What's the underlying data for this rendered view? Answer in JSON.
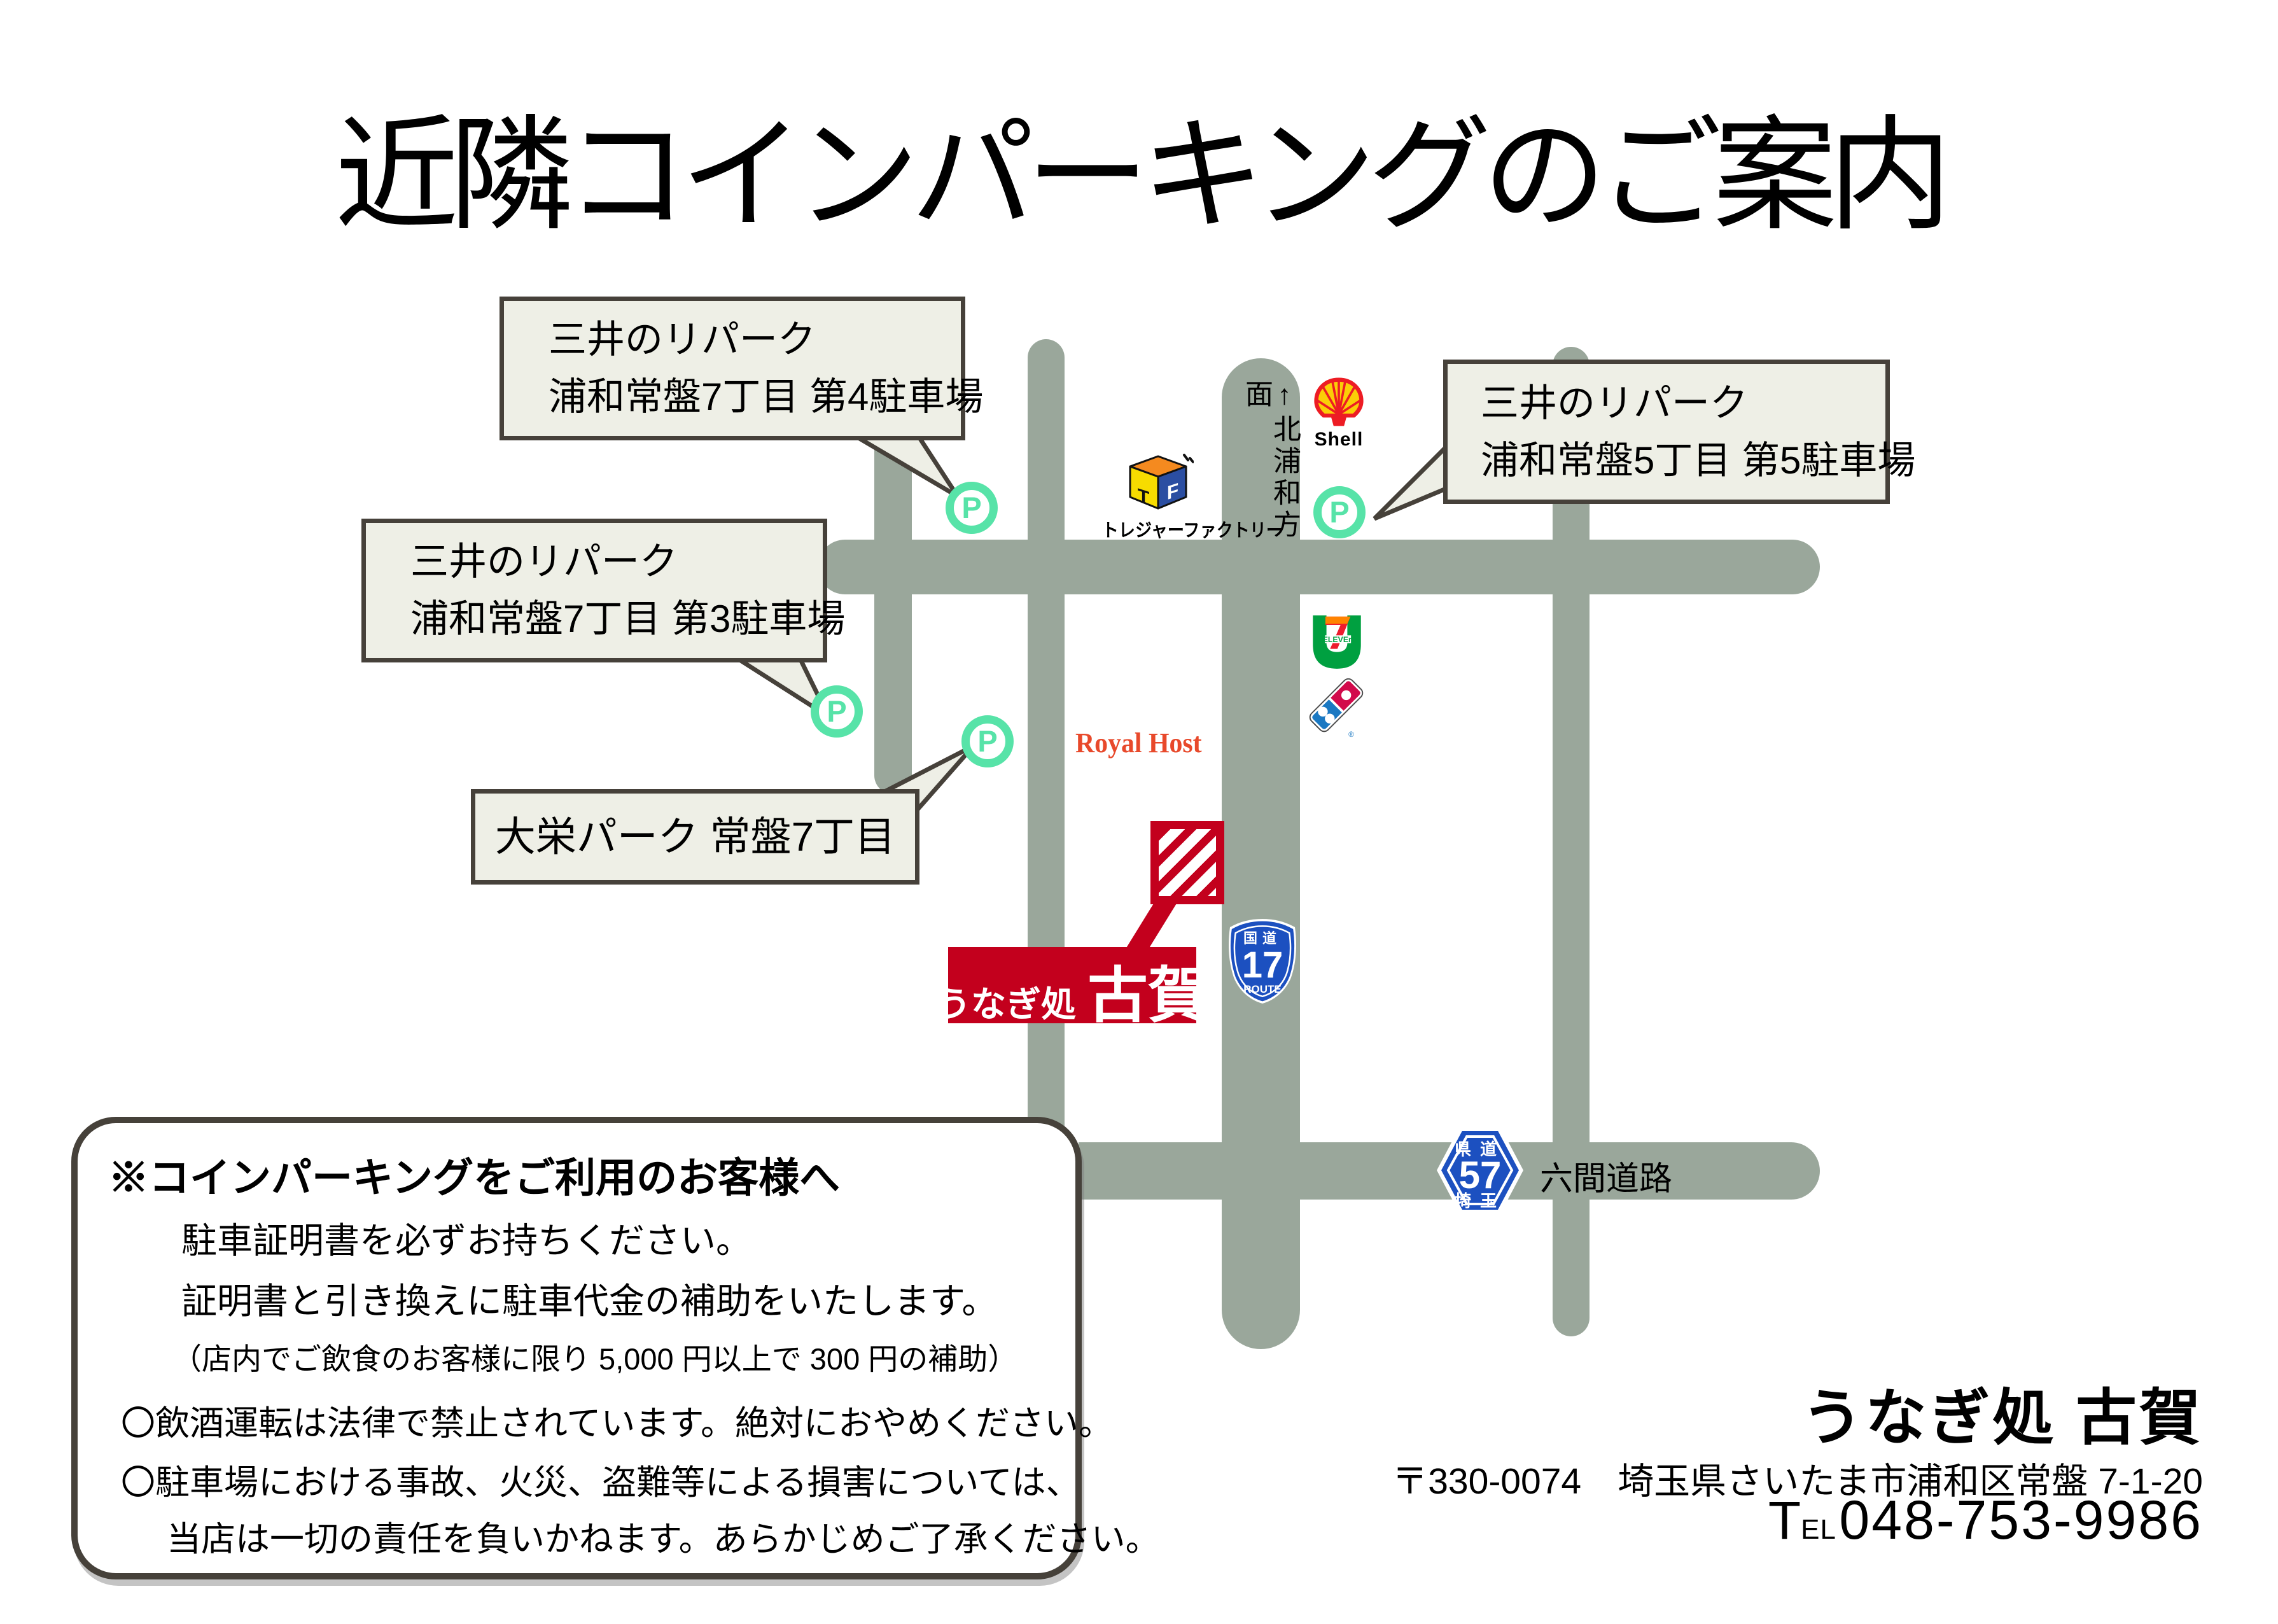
{
  "title": "近隣コインパーキングのご案内",
  "colors": {
    "road": "#9aa79b",
    "bubble_fill": "#eeefe6",
    "bubble_border": "#46413a",
    "parking_green": "#57e3a8",
    "restaurant_red": "#c3001d",
    "royal_host_red": "#e8492b",
    "route_sign_blue": "#1c50c0"
  },
  "bubbles": {
    "p4": {
      "line1": "三井のリパーク",
      "line2": "浦和常盤7丁目 第4駐車場"
    },
    "p3": {
      "line1": "三井のリパーク",
      "line2": "浦和常盤7丁目 第3駐車場"
    },
    "p5": {
      "line1": "三井のリパーク",
      "line2": "浦和常盤5丁目 第5駐車場"
    },
    "daiei": {
      "line1": "大栄パーク 常盤7丁目"
    }
  },
  "parking": {
    "letter": "P"
  },
  "pois": {
    "shell": {
      "label": "Shell"
    },
    "treasure_factory": {
      "label": "トレジャーファクトリー",
      "t": "T",
      "f": "F"
    },
    "seven_eleven": {
      "seven": "7",
      "eleven": "ELEVEn"
    },
    "dominos": {
      "reg": "®"
    },
    "royal_host": {
      "label": "Royal Host"
    }
  },
  "signs": {
    "route17": {
      "top": "国道",
      "number": "17",
      "bottom": "ROUTE"
    },
    "route57": {
      "top": "県道",
      "number": "57",
      "bottom": "埼玉"
    },
    "road_name": "六間道路",
    "direction": "↑北浦和方面"
  },
  "restaurant": {
    "label_small": "うなぎ処",
    "label_large": "古賀"
  },
  "notice": {
    "heading": "※コインパーキングをご利用のお客様へ",
    "lines": [
      "駐車証明書を必ずお持ちください。",
      "証明書と引き換えに駐車代金の補助をいたします。",
      "（店内でご飲食のお客様に限り 5,000 円以上で 300 円の補助）",
      "〇飲酒運転は法律で禁止されています。絶対におやめください。",
      "〇駐車場における事故、火災、盗難等による損害については、",
      "当店は一切の責任を負いかねます。あらかじめご了承ください。"
    ]
  },
  "footer": {
    "name": "うなぎ処 古賀",
    "address": "〒330-0074　埼玉県さいたま市浦和区常盤 7-1-20",
    "tel_t": "T",
    "tel_el": "EL",
    "tel_number": "048-753-9986"
  }
}
